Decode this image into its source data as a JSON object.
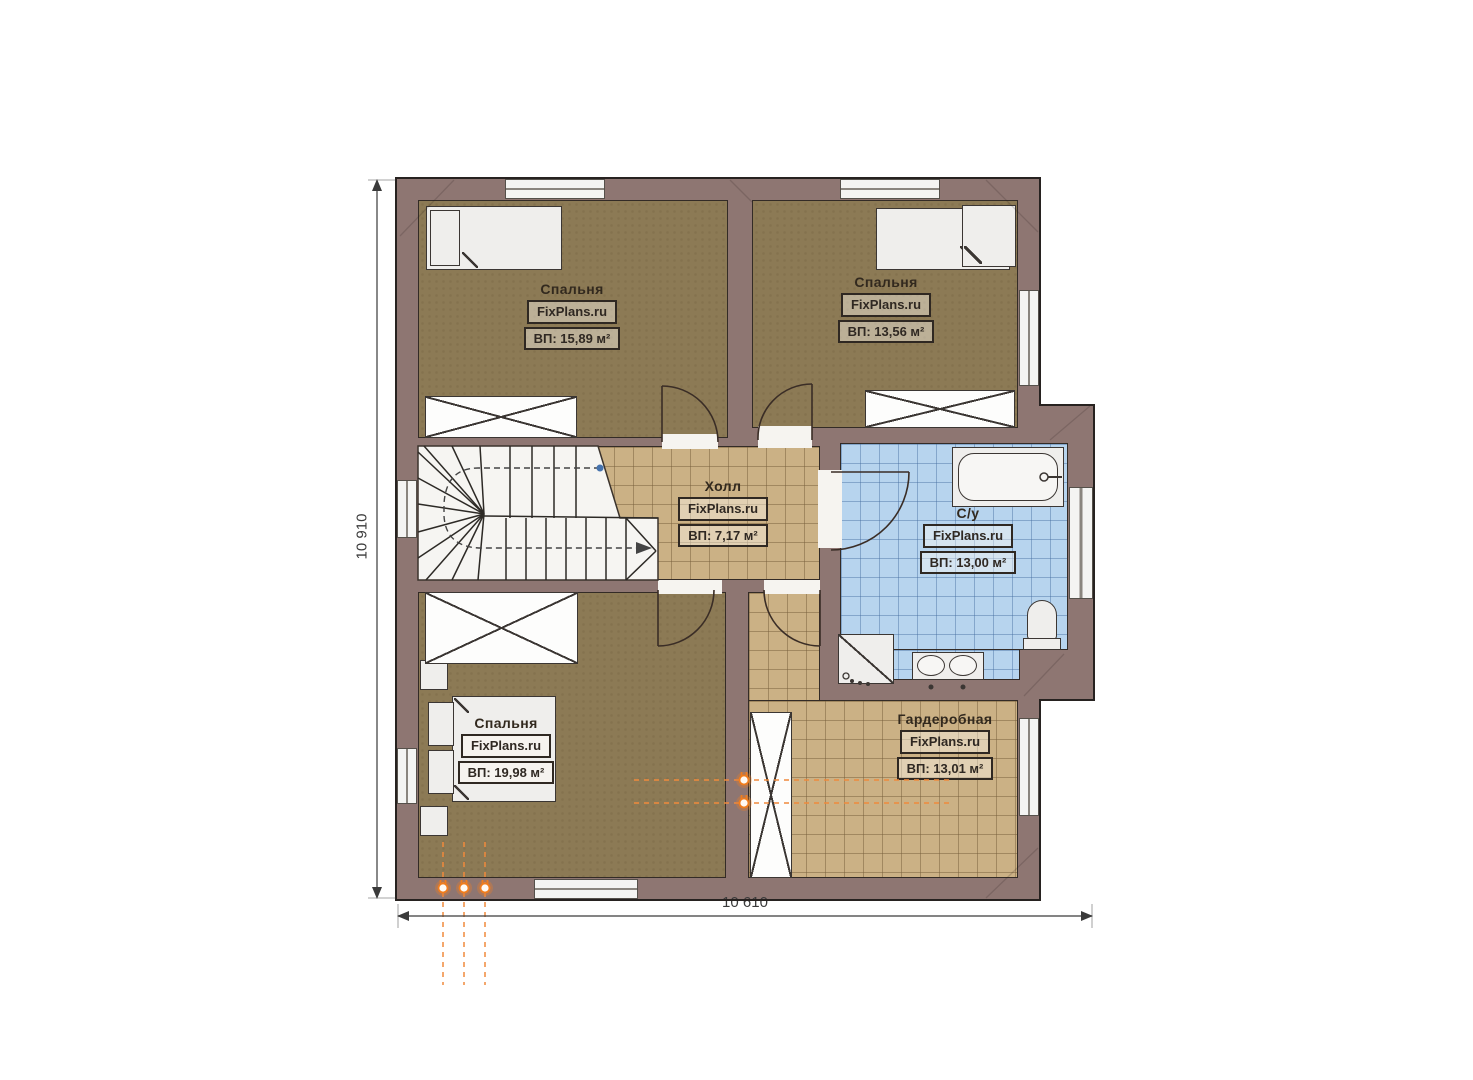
{
  "plan": {
    "brand": "FixPlans.ru",
    "rooms": [
      {
        "id": "bedroom-top-left",
        "name": "Спальня",
        "brand": "FixPlans.ru",
        "area": "ВП: 15,89 м²"
      },
      {
        "id": "bedroom-top-right",
        "name": "Спальня",
        "brand": "FixPlans.ru",
        "area": "ВП: 13,56 м²"
      },
      {
        "id": "hall",
        "name": "Холл",
        "brand": "FixPlans.ru",
        "area": "ВП: 7,17 м²"
      },
      {
        "id": "bathroom",
        "name": "С/у",
        "brand": "FixPlans.ru",
        "area": "ВП: 13,00 м²"
      },
      {
        "id": "bedroom-bottom",
        "name": "Спальня",
        "brand": "FixPlans.ru",
        "area": "ВП: 19,98 м²"
      },
      {
        "id": "wardrobe-room",
        "name": "Гардеробная",
        "brand": "FixPlans.ru",
        "area": "ВП: 13,01 м²"
      }
    ],
    "dimensions": {
      "height": "10 910",
      "width": "10 610"
    }
  },
  "colors": {
    "wall": "#8e7672",
    "bedroom": "#8c7a55",
    "tile": "#cbb185",
    "bath": "#b7d4ee",
    "socket": "#ef7d1e",
    "outline": "#332b26"
  }
}
